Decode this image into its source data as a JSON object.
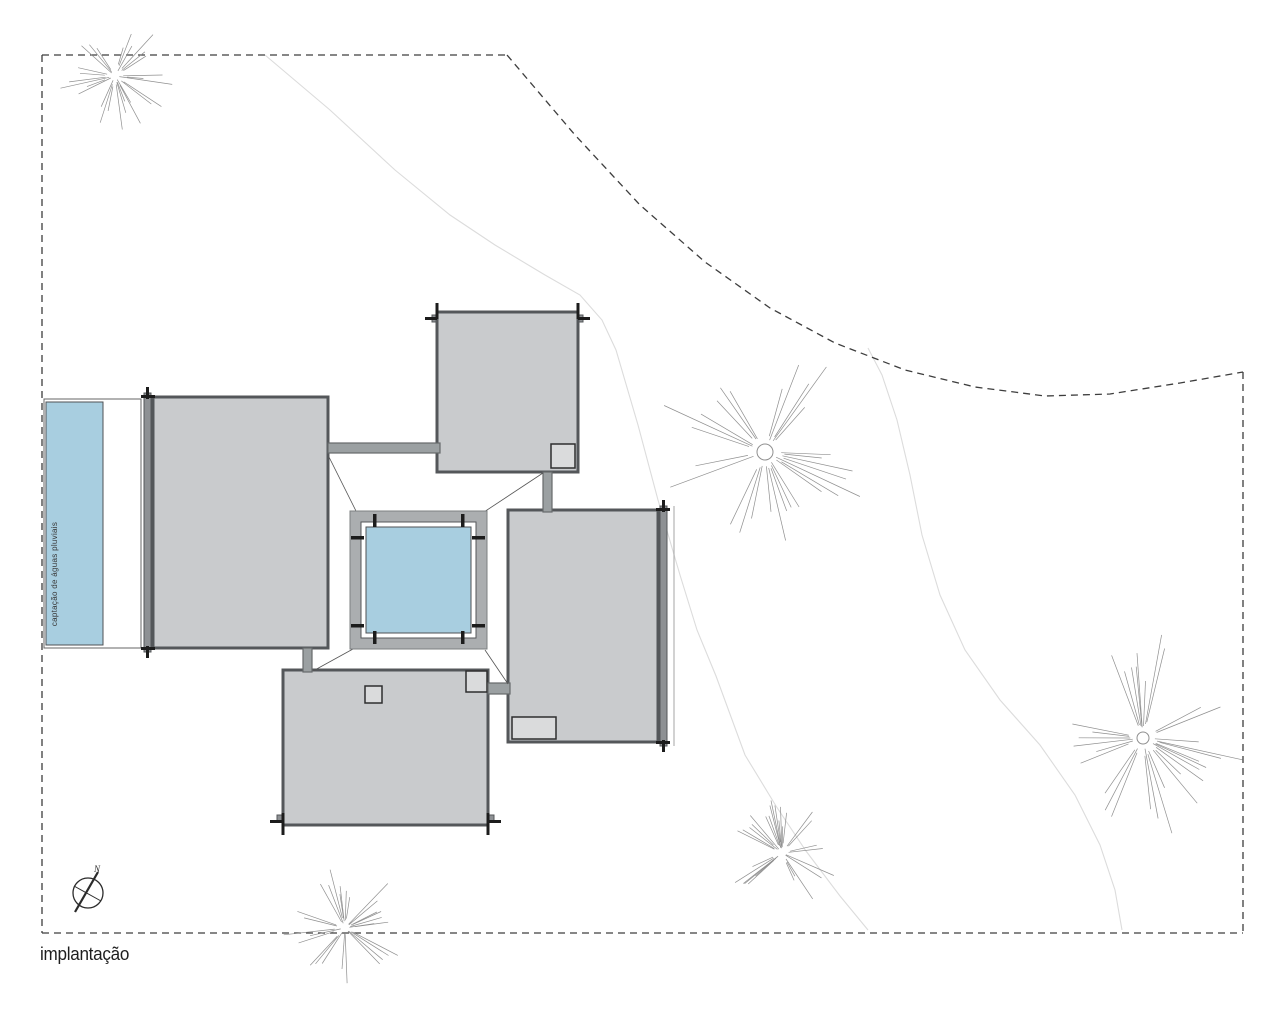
{
  "title": {
    "label": "implantação"
  },
  "compass": {
    "label": "N",
    "cx": 88,
    "cy": 893,
    "r": 15
  },
  "water_strip": {
    "annotation": "captação de águas pluviais",
    "outer": [
      44,
      399,
      97,
      249
    ],
    "blue": [
      46,
      402,
      57,
      243
    ],
    "text_pos": [
      57,
      574
    ]
  },
  "colors": {
    "background": "#ffffff",
    "building_fill": "#c9cbcd",
    "building_border": "#54575a",
    "beam_fill": "#8e9194",
    "post": "#1c1c1c",
    "walkway_fill": "#9ba0a2",
    "walkway_border": "#66696b",
    "pool_frame": "#abaeb0",
    "pool_frame_border": "#7d8082",
    "water": "#a8cee0",
    "water_border": "#4f5254",
    "square_fill": "#dadbdc",
    "square_border": "#2e2e2e",
    "boundary": "#3d3d3d",
    "contour": "#dcdcdc",
    "tree": "#8f8f8f",
    "diagonal": "#555555",
    "compass": "#2b2b2b",
    "offset_line": "#a5a5a5",
    "text": "#1e1e1e"
  },
  "boundary": {
    "dash": "7 5",
    "lines": [
      [
        42,
        55,
        42,
        933
      ],
      [
        42,
        55,
        507,
        55
      ],
      [
        42,
        933,
        1243,
        933
      ],
      [
        1243,
        372,
        1243,
        933
      ]
    ],
    "curve": [
      [
        507,
        55
      ],
      [
        575,
        135
      ],
      [
        640,
        205
      ],
      [
        705,
        262
      ],
      [
        770,
        308
      ],
      [
        835,
        343
      ],
      [
        905,
        370
      ],
      [
        975,
        387
      ],
      [
        1045,
        396
      ],
      [
        1110,
        394
      ],
      [
        1180,
        383
      ],
      [
        1243,
        372
      ]
    ]
  },
  "contours": [
    [
      [
        265,
        55
      ],
      [
        330,
        110
      ],
      [
        395,
        170
      ],
      [
        450,
        215
      ],
      [
        495,
        245
      ],
      [
        545,
        275
      ],
      [
        580,
        295
      ],
      [
        602,
        320
      ],
      [
        616,
        350
      ],
      [
        638,
        425
      ],
      [
        658,
        500
      ],
      [
        680,
        575
      ],
      [
        697,
        630
      ],
      [
        716,
        676
      ],
      [
        745,
        755
      ],
      [
        776,
        806
      ],
      [
        806,
        851
      ],
      [
        840,
        896
      ],
      [
        868,
        930
      ]
    ],
    [
      [
        868,
        348
      ],
      [
        882,
        375
      ],
      [
        897,
        420
      ],
      [
        910,
        475
      ],
      [
        922,
        535
      ],
      [
        940,
        595
      ],
      [
        965,
        650
      ],
      [
        1000,
        700
      ],
      [
        1040,
        745
      ],
      [
        1075,
        795
      ],
      [
        1100,
        845
      ],
      [
        1115,
        890
      ],
      [
        1122,
        930
      ]
    ]
  ],
  "buildings": [
    {
      "name": "pavilion-north",
      "x": 437,
      "y": 312,
      "w": 141,
      "h": 160,
      "beam": "top"
    },
    {
      "name": "pavilion-west",
      "x": 153,
      "y": 397,
      "w": 175,
      "h": 251,
      "beam": "left"
    },
    {
      "name": "pavilion-east",
      "x": 508,
      "y": 510,
      "w": 150,
      "h": 232,
      "beam": "right"
    },
    {
      "name": "pavilion-south",
      "x": 283,
      "y": 670,
      "w": 205,
      "h": 155,
      "beam": "bottom"
    }
  ],
  "interior_squares": [
    [
      551,
      444,
      24,
      24
    ],
    [
      512,
      717,
      44,
      22
    ],
    [
      365,
      686,
      17,
      17
    ],
    [
      466,
      671,
      21,
      21
    ]
  ],
  "walkways": [
    [
      328,
      443,
      112,
      10
    ],
    [
      543,
      472,
      9,
      40
    ],
    [
      303,
      648,
      9,
      24
    ],
    [
      488,
      683,
      22,
      11
    ]
  ],
  "diagonals": [
    [
      329,
      457,
      356,
      511
    ],
    [
      543,
      473,
      484,
      512
    ],
    [
      353,
      649,
      313,
      671
    ],
    [
      485,
      650,
      508,
      684
    ]
  ],
  "pool_court": {
    "frame": [
      350,
      511,
      137,
      138
    ],
    "deck_white": [
      361,
      522,
      115,
      116
    ],
    "water": [
      366,
      527,
      105,
      106
    ],
    "posts_v": [
      [
        373,
        514
      ],
      [
        461,
        514
      ],
      [
        373,
        631
      ],
      [
        461,
        631
      ]
    ],
    "posts_h": [
      [
        351,
        536
      ],
      [
        351,
        624
      ],
      [
        472,
        536
      ],
      [
        472,
        624
      ]
    ]
  },
  "trees": [
    {
      "cx": 115,
      "cy": 76,
      "r": 58,
      "seed": 7,
      "hub": 0
    },
    {
      "cx": 765,
      "cy": 452,
      "r": 112,
      "seed": 13,
      "hub": 8
    },
    {
      "cx": 1143,
      "cy": 738,
      "r": 105,
      "seed": 29,
      "hub": 6
    },
    {
      "cx": 345,
      "cy": 928,
      "r": 62,
      "seed": 41,
      "hub": 0
    },
    {
      "cx": 782,
      "cy": 853,
      "r": 58,
      "seed": 53,
      "hub": 0
    }
  ]
}
